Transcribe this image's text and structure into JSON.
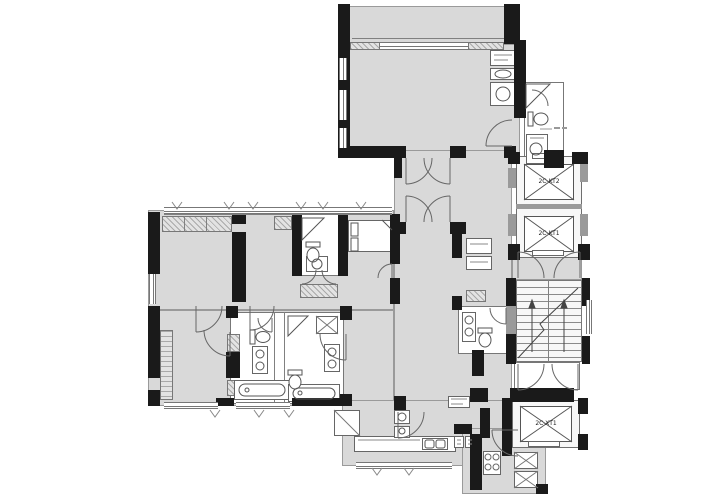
{
  "title": "residential-floor-plan",
  "colors": {
    "room": "#d9d9d9",
    "wall": "#1a1a1a",
    "line": "#777777",
    "fixture_bg": "#ffffff",
    "hatch": "#bdbdbd"
  },
  "elevators": [
    {
      "label": "2C-KT2"
    },
    {
      "label": "2C-KT1"
    },
    {
      "label": "2C-XT1"
    }
  ]
}
